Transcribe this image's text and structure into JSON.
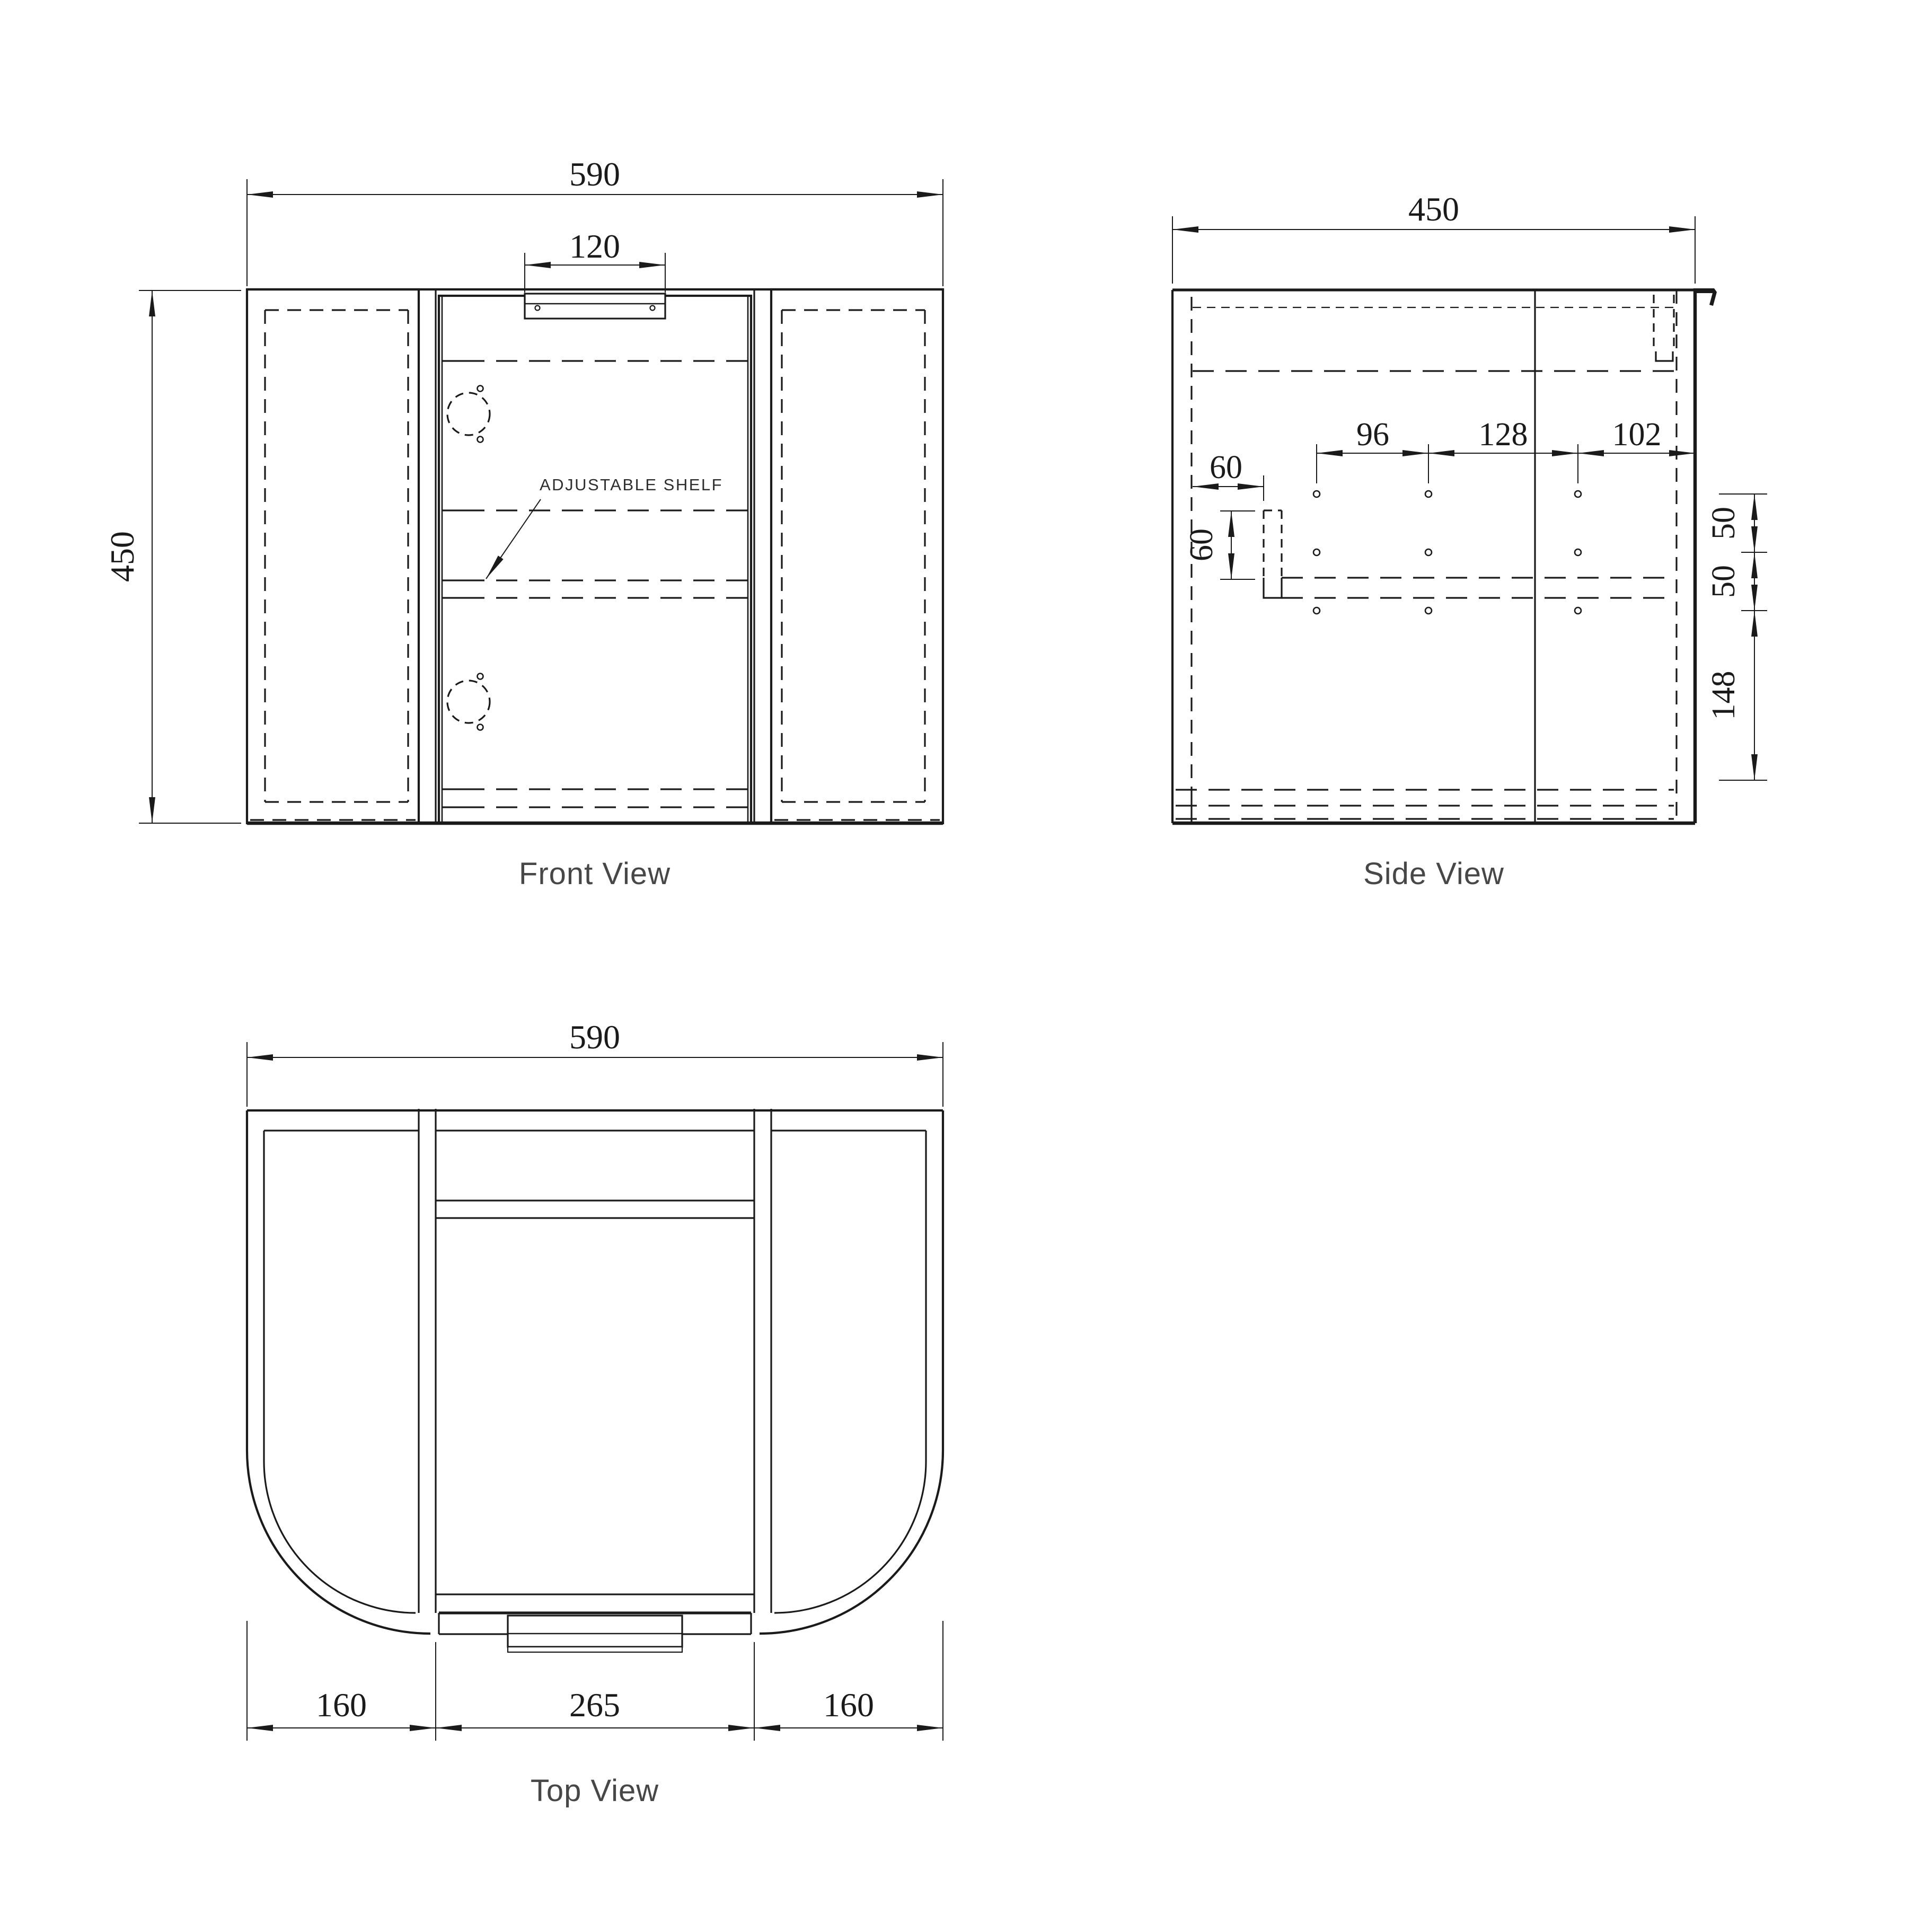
{
  "colors": {
    "ink": "#1a1a1a",
    "background": "#ffffff"
  },
  "front": {
    "title": "Front View",
    "shelf_label": "ADJUSTABLE SHELF",
    "dim_overall_width": "590",
    "dim_handle_width": "120",
    "dim_height": "450"
  },
  "side": {
    "title": "Side View",
    "dim_overall_depth": "450",
    "dim_hole_back_span": "96",
    "dim_hole_mid_span": "128",
    "dim_hole_front_span": "102",
    "dim_rail_setback": "60",
    "dim_rail_height": "60",
    "dim_hole_gap_top": "50",
    "dim_hole_gap_bottom": "50",
    "dim_hole_bottom_offset": "148"
  },
  "top": {
    "title": "Top View",
    "dim_overall_width": "590",
    "dim_side_left": "160",
    "dim_door_span": "265",
    "dim_side_right": "160"
  }
}
